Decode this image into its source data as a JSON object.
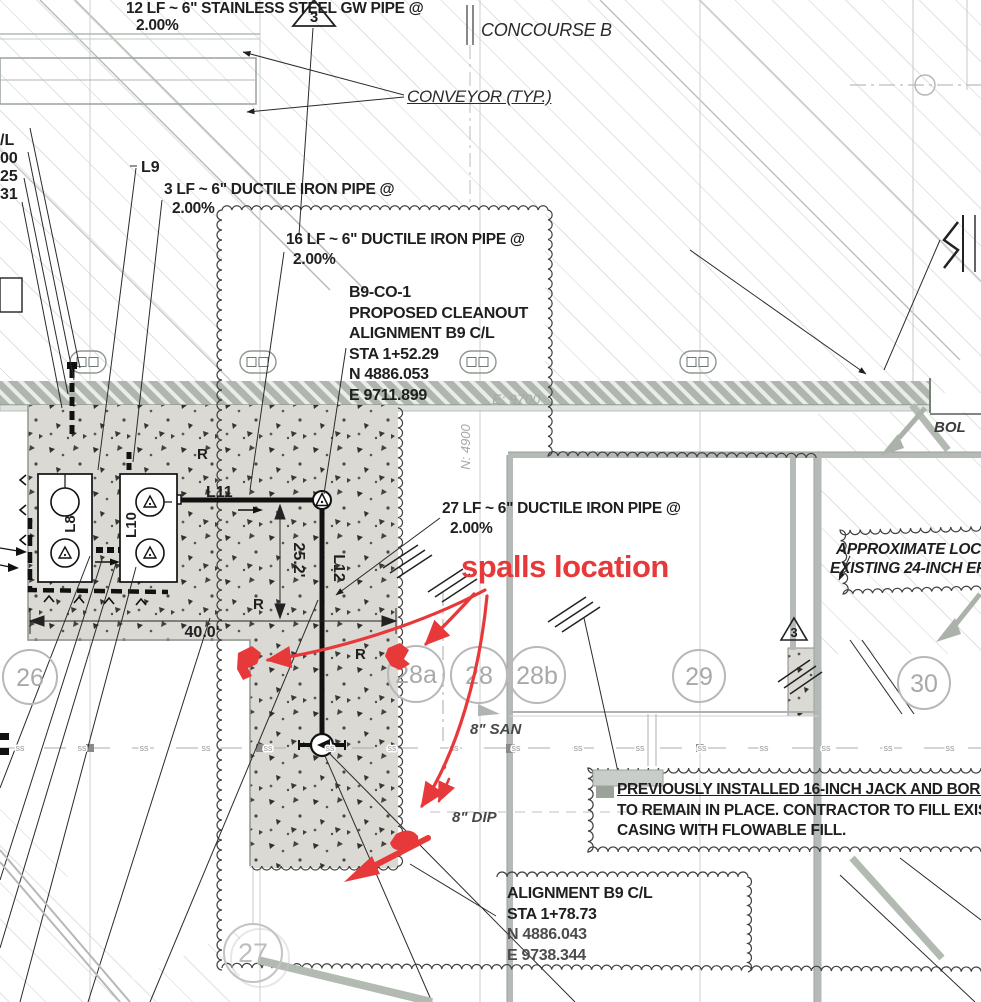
{
  "colors": {
    "annotation_red": "#e8393a",
    "drawing_gray": "#9aa29a",
    "stipple_bg": "#dbd9d3"
  },
  "deltas": {
    "top": "3",
    "right": "3"
  },
  "notes": {
    "gw_pipe": {
      "line1": "12 LF ~ 6\"  STAINLESS STEEL GW PIPE @",
      "line2": "2.00%"
    },
    "dip3": {
      "line1": "3 LF ~ 6\"  DUCTILE IRON PIPE @",
      "line2": "2.00%"
    },
    "dip16": {
      "line1": "16 LF ~ 6\"  DUCTILE IRON PIPE @",
      "line2": "2.00%"
    },
    "dip27": {
      "line1": "27 LF ~ 6\"  DUCTILE IRON PIPE @",
      "line2": "2.00%"
    },
    "cleanout1": {
      "l1": "B9-CO-1",
      "l2": "PROPOSED CLEANOUT",
      "l3": "ALIGNMENT B9 C/L",
      "l4": "STA 1+52.29",
      "l5": "N 4886.053",
      "l6": "E 9711.899"
    },
    "approx": {
      "line1": "APPROXIMATE LOCAT",
      "line2": "EXISTING 24-INCH EF"
    },
    "casing": {
      "line1": "PREVIOUSLY INSTALLED 16-INCH JACK AND BORE C",
      "line2": "TO REMAIN IN PLACE. CONTRACTOR TO FILL EXISTI",
      "line3": "CASING WITH FLOWABLE FILL."
    },
    "cleanout2": {
      "l1": "ALIGNMENT B9 C/L",
      "l2": "STA 1+78.73",
      "l3": "N 4886.043",
      "l4": "E 9738.344"
    }
  },
  "labels": {
    "concourse": "CONCOURSE B",
    "conveyor": "CONVEYOR (TYP.)",
    "l8": "L8",
    "l9": "L9",
    "l10": "L10",
    "l11": "L11",
    "l12": "L12",
    "r": "R",
    "san": "8\" SAN",
    "dip": "8\" DIP",
    "bol": "BOL",
    "easting": "E: 9700",
    "northing": "N: 4900",
    "ss": "ss"
  },
  "dimensions": {
    "width": "40.0'",
    "height": "25.2'"
  },
  "grid_bubbles": {
    "b26": "26",
    "b27": "27",
    "b28a": "28a",
    "b28": "28",
    "b28b": "28b",
    "b29": "29",
    "b30": "30"
  },
  "edge_fragments": {
    "f1": "/L",
    "f2": "00",
    "f3": "25",
    "f4": "31"
  },
  "annotation": {
    "spalls": "spalls location"
  }
}
